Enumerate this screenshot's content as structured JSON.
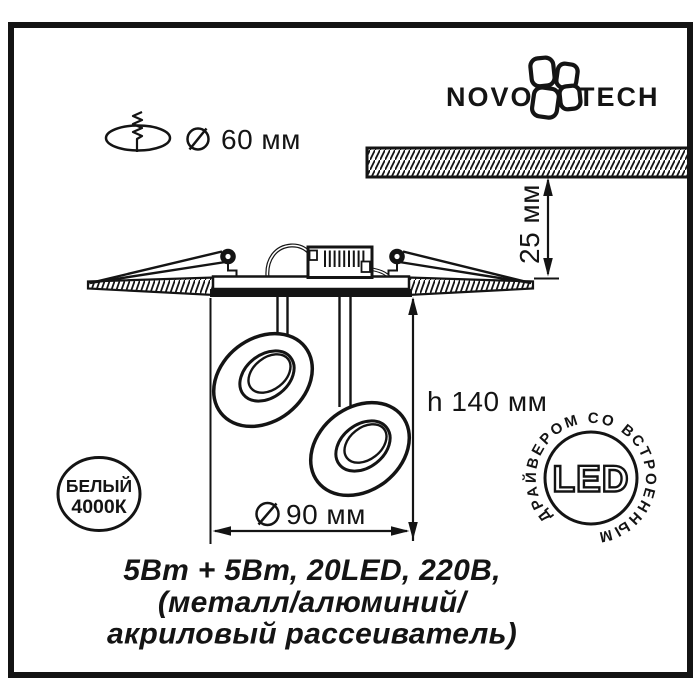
{
  "brand": {
    "logo_left": "NOVO",
    "logo_right": "TECH"
  },
  "mounting": {
    "hole_diameter_label": "60 мм"
  },
  "ceiling": {
    "recess_depth_label": "25 мм"
  },
  "fixture": {
    "height_label": "h 140 мм",
    "head_diameter_label": "90 мм"
  },
  "badges": {
    "color_temp": {
      "line1": "БЕЛЫЙ",
      "line2": "4000К"
    },
    "led": {
      "center_label": "LED",
      "ring_label": "ДРАЙВЕРОМ СО ВСТРОЕННЫМ"
    }
  },
  "specs": {
    "line1": "5Вт + 5Вт, 20LED, 220В,",
    "line2": "(металл/алюминий/",
    "line3": "акриловый рассеиватель)"
  },
  "colors": {
    "ink": "#141414",
    "background": "#ffffff"
  }
}
